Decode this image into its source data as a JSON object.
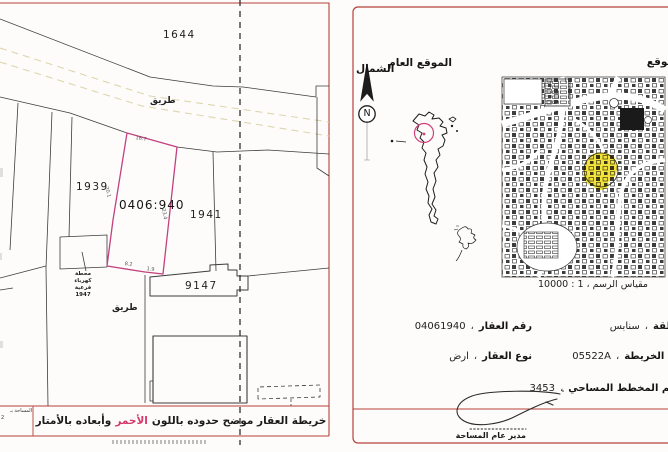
{
  "left_map": {
    "parcel_1644": "1644",
    "parcel_1939": "1939",
    "parcel_1941": "1941",
    "parcel_9147": "9147",
    "subject_plot_number": "0406:940",
    "road_label_top": "طريق",
    "road_label_bottom": "طريق",
    "substation_label": "محطة\nكهرباء\nفرعية\n1947",
    "dimensions": {
      "top": "16.7",
      "left": "20.1",
      "right": "23.4",
      "bottom_left": "8.2",
      "bottom_right": "1.9"
    },
    "area_box": {
      "line1": "المساحة بـ",
      "line2": "2"
    },
    "caption": {
      "pre": "خريطة العقار موضح حدوده باللون",
      "highlight": "الأحمر",
      "post": "وأبعاده بالأمتار"
    }
  },
  "right_panel": {
    "north_label": "الشمال",
    "north_letter": "N",
    "general_location_label": "الموقع العام",
    "site_label": "الموقع",
    "scale_caption": "مقياس الرسم ، 1 : 10000",
    "separator": "،",
    "details_left": [
      {
        "label": "رقم العقار",
        "value": "04061940"
      },
      {
        "label": "نوع العقار",
        "value": "ارض"
      }
    ],
    "details_right": [
      {
        "label": "المنطقة",
        "value": "سنابس"
      },
      {
        "label": "رقم الخريطة",
        "value": "05522A"
      },
      {
        "label": "رقم المخطط المساحي",
        "value": "3453"
      }
    ],
    "signature_title": "مدير عام المساحة"
  },
  "colors": {
    "border_red": "#b5413a",
    "plot_outline_magenta": "#c2417f",
    "highlight_word_red": "#d23a6b",
    "map_highlight_yellow": "#f2e23b"
  }
}
